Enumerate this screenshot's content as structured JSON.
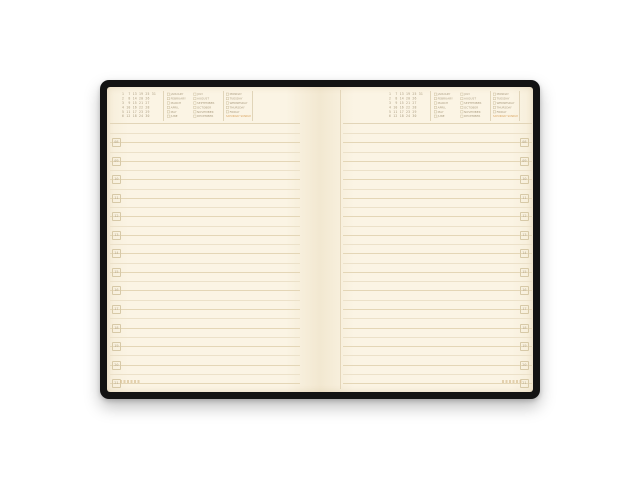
{
  "scene": {
    "description": "open undated daily planner notebook with black cover on white background",
    "background_color": "#ffffff"
  },
  "book": {
    "cover_color": "#131313",
    "paper_color": "#fbf4e4",
    "rule_color": "#e4d6b6",
    "text_color": "#ab9d80",
    "accent_weekend_color": "#d9a25c"
  },
  "header": {
    "dates_grid_rows": [
      "1  7 13 19 25 31",
      "2  8 14 20 26",
      "3  9 15 21 27",
      "4 10 16 22 28",
      "5 11 17 23 29",
      "6 12 18 24 30"
    ],
    "months_col1": [
      "JANUARY",
      "FEBRUARY",
      "MARCH",
      "APRIL",
      "MAY",
      "JUNE"
    ],
    "months_col2": [
      "JULY",
      "AUGUST",
      "SEPTEMBER",
      "OCTOBER",
      "NOVEMBER",
      "DECEMBER"
    ],
    "weekdays": [
      "MONDAY",
      "TUESDAY",
      "WEDNESDAY",
      "THURSDAY",
      "FRIDAY"
    ],
    "weekend_label": "SATURDAY  SUNDAY"
  },
  "hours": [
    "08",
    "09",
    "10",
    "11",
    "12",
    "13",
    "14",
    "15",
    "16",
    "17",
    "18",
    "19",
    "20",
    "21"
  ],
  "layout": {
    "ruled_lines_per_page": 28,
    "pages": [
      "left",
      "right"
    ]
  }
}
